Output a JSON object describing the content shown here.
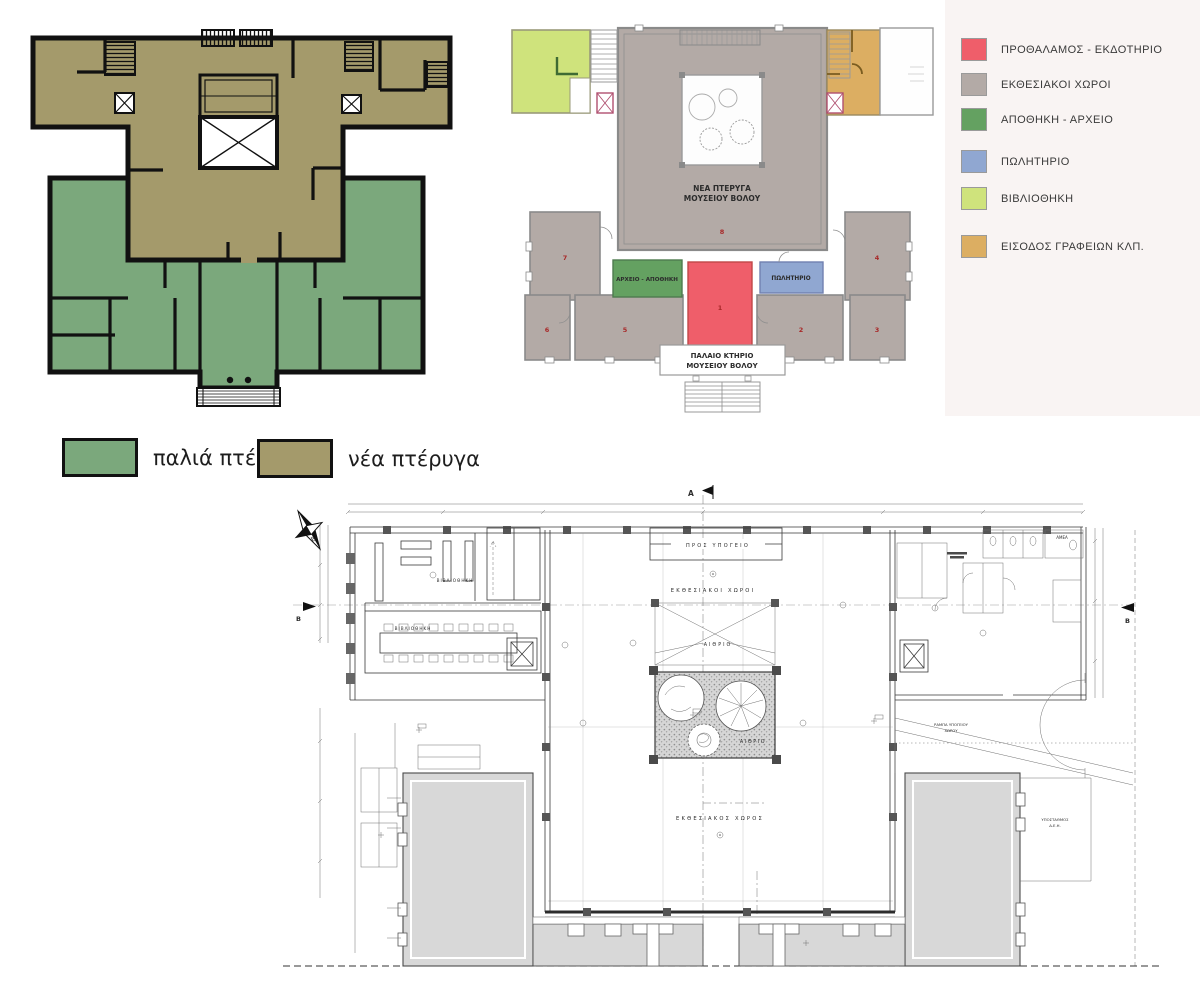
{
  "page": {
    "background": "#ffffff"
  },
  "mini_legend": {
    "old_label": "παλιά πτέρυγα",
    "new_label": "νέα πτέρυγα",
    "old_color": "#7ba87c",
    "new_color": "#a49a6b"
  },
  "legend": {
    "panel_color": "#f9f4f3",
    "items": [
      {
        "label": "ΠΡΟΘΑΛΑΜΟΣ - ΕΚΔΟΤΗΡΙΟ",
        "color": "#ef5e6a"
      },
      {
        "label": "ΕΚΘΕΣΙΑΚΟΙ ΧΩΡΟΙ",
        "color": "#b3aaa6"
      },
      {
        "label": "ΑΠΟΘΗΚΗ - ΑΡΧΕΙΟ",
        "color": "#64a161"
      },
      {
        "label": "ΠΩΛΗΤΗΡΙΟ",
        "color": "#90a7d1"
      },
      {
        "label": "ΒΙΒΛΙΟΘΗΚΗ",
        "color": "#cfe37c"
      },
      {
        "label": "ΕΙΣΟΔΟΣ ΓΡΑΦΕΙΩΝ ΚΛΠ.",
        "color": "#dcae62"
      }
    ]
  },
  "colored_plan": {
    "title_line1": "ΝΕΑ ΠΤΕΡΥΓΑ",
    "title_line2": "ΜΟΥΣΕΙΟΥ ΒΟΛΟΥ",
    "old_line1": "ΠΑΛΑΙΟ ΚΤΗΡΙΟ",
    "old_line2": "ΜΟΥΣΕΙΟΥ ΒΟΛΟΥ",
    "archive_label": "ΑΡΧΕΙΟ - ΑΠΟΘΗΚΗ",
    "shop_label": "ΠΩΛΗΤΗΡΙΟ",
    "room_numbers": {
      "r1": "1",
      "r2": "2",
      "r3": "3",
      "r4": "4",
      "r5": "5",
      "r6": "6",
      "r7": "7",
      "r8": "8"
    }
  },
  "tech_drawing": {
    "labels": {
      "to_basement": "ΠΡΟΣ ΥΠΟΓΕΙΟ",
      "exhibition_spaces": "ΕΚΘΕΣΙΑΚΟΙ ΧΩΡΟΙ",
      "exhibition_space": "ΕΚΘΕΣΙΑΚΟΣ ΧΩΡΟΣ",
      "atrium_top": "ΑΙΘΡΙΟ",
      "atrium_inner": "ΑΙΘΡΙΟ",
      "library_upper": "ΒΙΒΛΙΟΘΗΚΗ",
      "library_lower": "ΒΙΒΛΙΟΘΗΚΗ",
      "ramp_line1": "ΡΑΜΠΑ ΥΠΟΓΕΙΟΥ",
      "ramp_line2": "ΧΩΡΟΥ",
      "substation_line1": "ΥΠΟΣΤΑΘΜΟΣ",
      "substation_line2": "Δ.Ε.Η.",
      "amea": "ΑΜΕΑ",
      "section_a": "A",
      "section_b_left": "B",
      "section_b_right": "B",
      "section_c": "Γ",
      "compass_letter": "Β"
    }
  }
}
